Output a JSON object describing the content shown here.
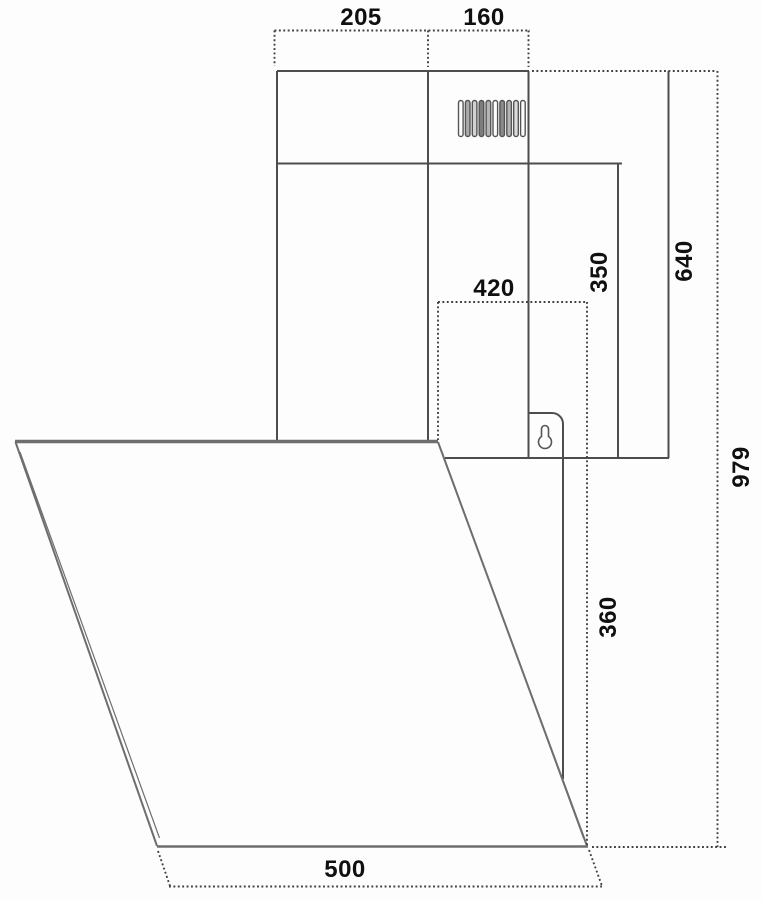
{
  "diagram": {
    "type": "technical dimension drawing",
    "subject": "angled wall-mounted cooker hood, side profile with chimney duct, vent grille, keyhole wall bracket and slanted glass front panel",
    "unit": "mm",
    "line_color": "#4d4d4d",
    "glass_edge_color": "#6e6e6e",
    "dimension_style": "dotted extension lines, bold black labels",
    "dimensions": {
      "chimney_depth_back": "205",
      "chimney_depth_front": "160",
      "panel_top_depth": "420",
      "lower_chimney_height": "350",
      "chimney_total_height": "640",
      "overall_height": "979",
      "body_height": "360",
      "bottom_depth": "500"
    }
  }
}
